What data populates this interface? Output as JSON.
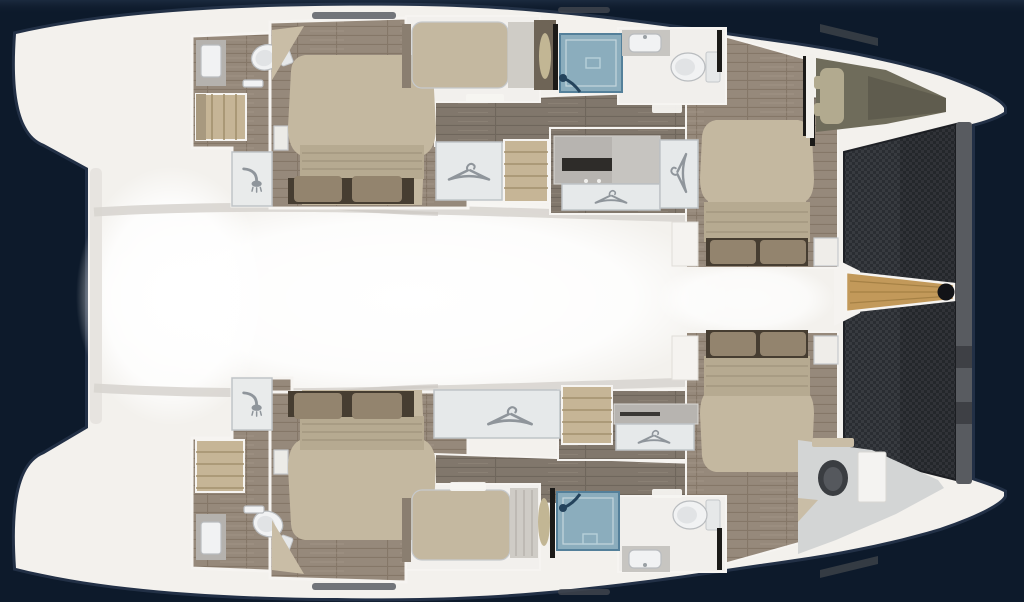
{
  "diagram": {
    "type": "catamaran-interior-floor-plan",
    "view": "top-down",
    "bow_direction": "right",
    "bridge_deck": {
      "areas": [
        "aft-deck",
        "salon",
        "foredeck"
      ]
    },
    "bow": {
      "features": [
        "trampoline-net",
        "forestay-beam",
        "bowsprit",
        "bowsprit-end-fitting"
      ]
    },
    "hulls": [
      {
        "id": "port-hull",
        "position": "top",
        "rooms": [
          {
            "name": "aft-head",
            "fixtures": [
              "sink",
              "toilet",
              "towel-rail",
              "stairs",
              "shower"
            ]
          },
          {
            "name": "aft-cabin",
            "fixtures": [
              "double-island-bed",
              "pillows",
              "headboard",
              "corner-shelf",
              "nightstand"
            ]
          },
          {
            "name": "single-berth-room",
            "fixtures": [
              "single-berth",
              "bolster",
              "locker"
            ]
          },
          {
            "name": "companionway",
            "fixtures": [
              "wardrobe",
              "stairs",
              "corridor"
            ]
          },
          {
            "name": "dressing-area",
            "fixtures": [
              "dresser-cabinet",
              "hanging-locker",
              "hanging-locker"
            ]
          },
          {
            "name": "forward-head",
            "fixtures": [
              "shower-stall",
              "sink",
              "toilet"
            ]
          },
          {
            "name": "forward-cabin",
            "fixtures": [
              "double-bed",
              "pillows",
              "step-platform",
              "nightstand"
            ]
          },
          {
            "name": "forepeak",
            "fixtures": [
              "crew-berth",
              "pillow"
            ]
          }
        ]
      },
      {
        "id": "starboard-hull",
        "position": "bottom",
        "rooms": [
          {
            "name": "aft-head",
            "fixtures": [
              "sink",
              "toilet",
              "towel-rail",
              "stairs",
              "shower"
            ]
          },
          {
            "name": "aft-cabin",
            "fixtures": [
              "double-island-bed",
              "pillows",
              "headboard",
              "corner-shelf",
              "nightstand"
            ]
          },
          {
            "name": "single-berth-room",
            "fixtures": [
              "single-berth",
              "bolster"
            ]
          },
          {
            "name": "companionway",
            "fixtures": [
              "wardrobe",
              "stairs",
              "corridor"
            ]
          },
          {
            "name": "dressing-area",
            "fixtures": [
              "dresser-cabinet",
              "hanging-locker"
            ]
          },
          {
            "name": "forward-head",
            "fixtures": [
              "shower-stall",
              "sink",
              "toilet"
            ]
          },
          {
            "name": "forward-cabin",
            "fixtures": [
              "double-bed",
              "pillows",
              "step-platform",
              "nightstand"
            ]
          },
          {
            "name": "forepeak-head",
            "fixtures": [
              "toilet",
              "cabinet",
              "shelf"
            ]
          }
        ]
      }
    ],
    "element_counts": {
      "hanger_icons": 5,
      "shower_head_icons": 2,
      "shower_fixture_icons": 2,
      "white_toilets": 4,
      "dark_toilets": 1,
      "sinks": 4,
      "stairs": 4,
      "double_beds": 4,
      "single_berths": 2,
      "crew_berths": 1
    }
  },
  "icons": {
    "hanger-icon": "clothes-hanger glyph",
    "shower-head-icon": "shower-head glyph"
  },
  "colors": {
    "background": "#0d1a2b",
    "hull_white": "#f3f1ed",
    "deck_highlight": "#ffffff",
    "deck_shading": "#d8d5d0",
    "cabin_wood": "#96897b",
    "cabin_wood_seam": "#857768",
    "corridor_wood": "#81776c",
    "corridor_wood_seam": "#6f665c",
    "stairs_wood": "#c6b596",
    "stair_tread": "#a3926f",
    "mattress": "#c4b8a0",
    "mattress_fold": "#b6aa91",
    "pillow_brown": "#93846e",
    "headboard_dark": "#463d31",
    "wardrobe_panel": "#e6e9ea",
    "wardrobe_border": "#bfc4c7",
    "icon_gray": "#8f959b",
    "shower_blue": "#8badbd",
    "shower_blue_border": "#54809a",
    "shower_fixture_blue": "#24435c",
    "fixture_white": "#f1f2f3",
    "fixture_outline": "#b9bcbf",
    "toilet_dark": "#3a3d41",
    "counter_gray": "#c7c5c1",
    "cabinet_gray": "#b7b4b0",
    "cabinet_slot": "#2e2c29",
    "berth_trim": "#8a7e70",
    "dark_wood_band": "#6e6456",
    "bolster_tan": "#c2b694",
    "trampoline_base": "#383b40",
    "trampoline_check": "#2a2d32",
    "forestay_beam": "#585b60",
    "bowsprit_wood": "#c2995a",
    "bowsprit_line": "#a07c42",
    "fitting_black": "#121317",
    "bulkhead_black": "#1b1a18",
    "forepeak_olive": "#6f6c5b",
    "forepeak_pillow": "#b2aa8f",
    "bow_head_floor": "#d3d5d5",
    "shelf_tan": "#c9bda6",
    "hatch_dark": "#454a51"
  }
}
